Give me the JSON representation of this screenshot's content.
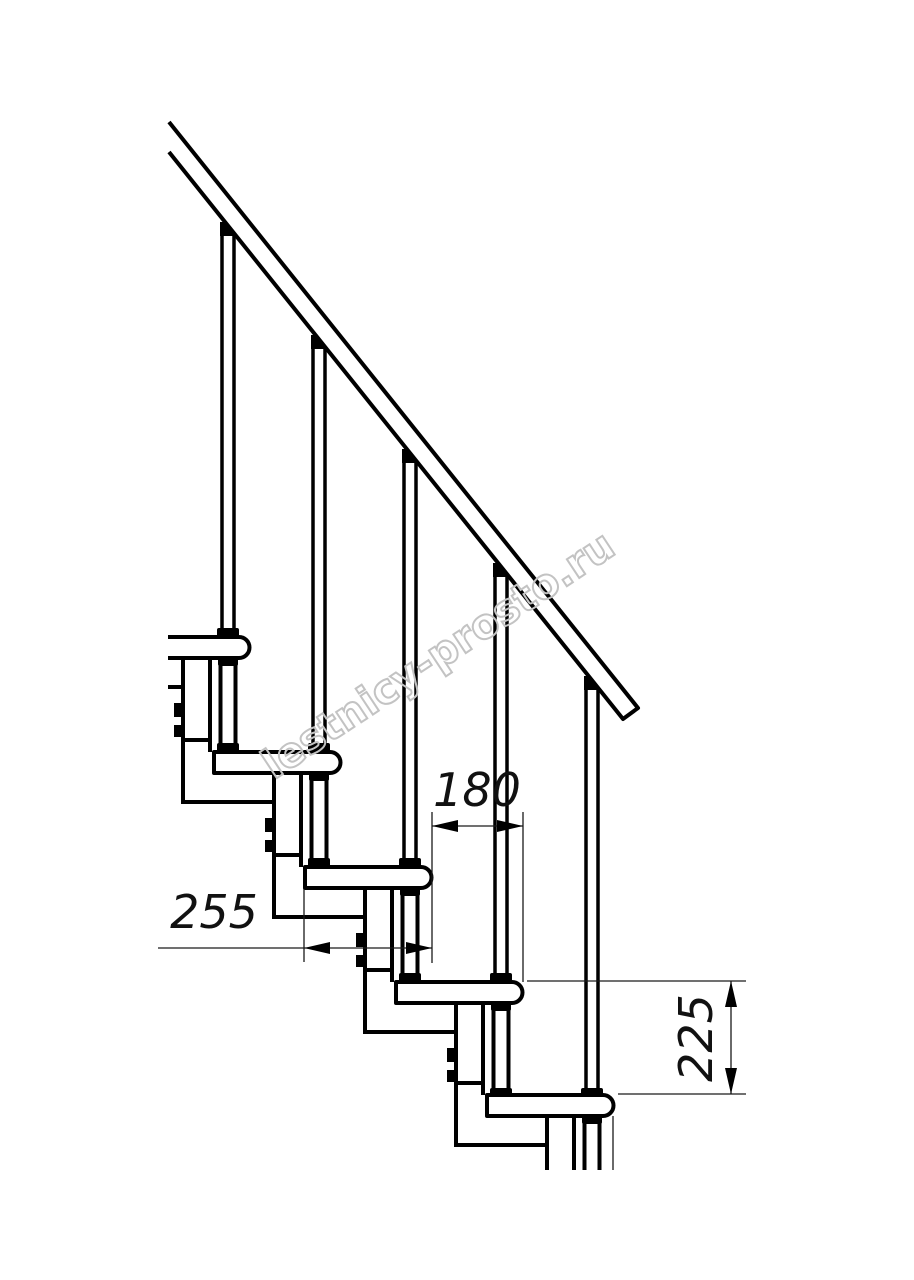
{
  "drawing": {
    "title": "staircase-side-view-technical-drawing",
    "watermark": "lestnicy-prosto.ru",
    "dimensions": {
      "going_label": "180",
      "tread_depth_label": "255",
      "rise_label": "225"
    },
    "colors": {
      "line": "#000000",
      "dimension": "#1a1a1a",
      "watermark": "#c3c3c3",
      "background": "#ffffff"
    }
  }
}
